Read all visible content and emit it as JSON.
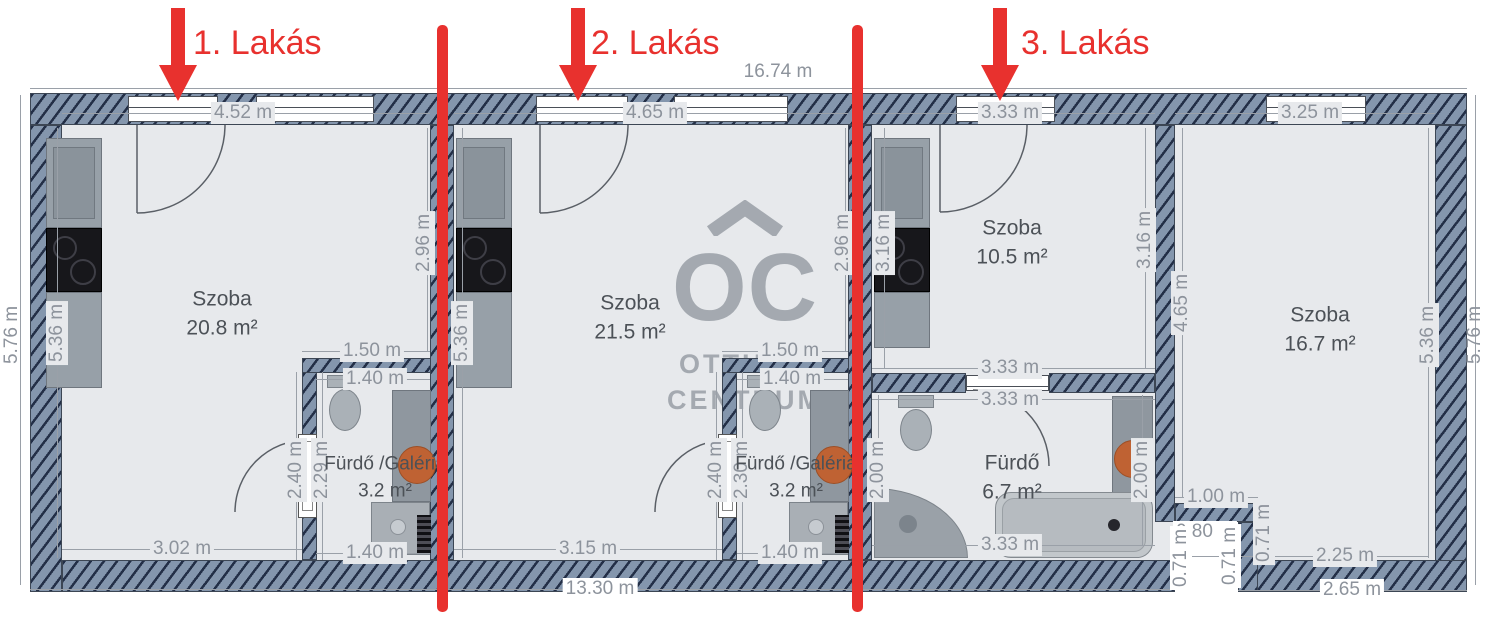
{
  "apartments": [
    {
      "label": "1. Lakás"
    },
    {
      "label": "2. Lakás"
    },
    {
      "label": "3. Lakás"
    }
  ],
  "watermark": {
    "logo": "OC",
    "line1": "OTTHON",
    "line2": "CENTRUM"
  },
  "rooms": {
    "apt1_szoba": {
      "name": "Szoba",
      "area": "20.8 m²"
    },
    "apt1_furdo": {
      "name": "Fürdő /Galéria",
      "area": "3.2 m²"
    },
    "apt2_szoba": {
      "name": "Szoba",
      "area": "21.5 m²"
    },
    "apt2_furdo": {
      "name": "Fürdő /Galéria",
      "area": "3.2 m²"
    },
    "apt3_szoba": {
      "name": "Szoba",
      "area": "10.5 m²"
    },
    "apt3_furdo": {
      "name": "Fürdő",
      "area": "6.7 m²"
    },
    "apt4_szoba": {
      "name": "Szoba",
      "area": "16.7 m²"
    }
  },
  "dimensions": {
    "overall_width": "16.74 m",
    "overall_bottom": "13.30 m",
    "left_outer": "5.76 m",
    "left_inner": "5.36 m",
    "right_outer": "5.76 m",
    "apt1_top": "4.52 m",
    "apt1_right": "2.96 m",
    "apt1_bottom": "3.02 m",
    "apt2_top": "4.65 m",
    "apt2_left": "5.36 m",
    "apt2_right": "2.96 m",
    "apt2_bottom": "3.15 m",
    "apt3_top": "3.33 m",
    "apt3_left": "3.16 m",
    "apt3_right": "3.16 m",
    "apt3_room_bottom": "3.33 m",
    "apt3_bath_top": "3.33 m",
    "apt3_bath_left": "2.00 m",
    "apt3_bath_right": "2.00 m",
    "apt3_bath_bottom": "3.33 m",
    "apt4_top": "3.25 m",
    "apt4_left": "4.65 m",
    "apt4_right": "5.36 m",
    "apt4_bottom_inner": "2.25 m",
    "apt4_bottom_outer": "2.65 m",
    "bath1_top": "1.50 m",
    "bath1_top_inner": "1.40 m",
    "bath1_left": "2.40 m",
    "bath1_left_inner": "2.29 m",
    "bath1_bottom": "1.40 m",
    "bath2_top": "1.50 m",
    "bath2_top_inner": "1.40 m",
    "bath2_left": "2.40 m",
    "bath2_left_inner": "2.30 m",
    "bath2_bottom": "1.40 m",
    "notch_top": "1.00 m",
    "notch_width": "0.80 m",
    "notch_left": "0.71 m",
    "notch_mid": "0.71 m",
    "notch_right": "0.71 m"
  }
}
